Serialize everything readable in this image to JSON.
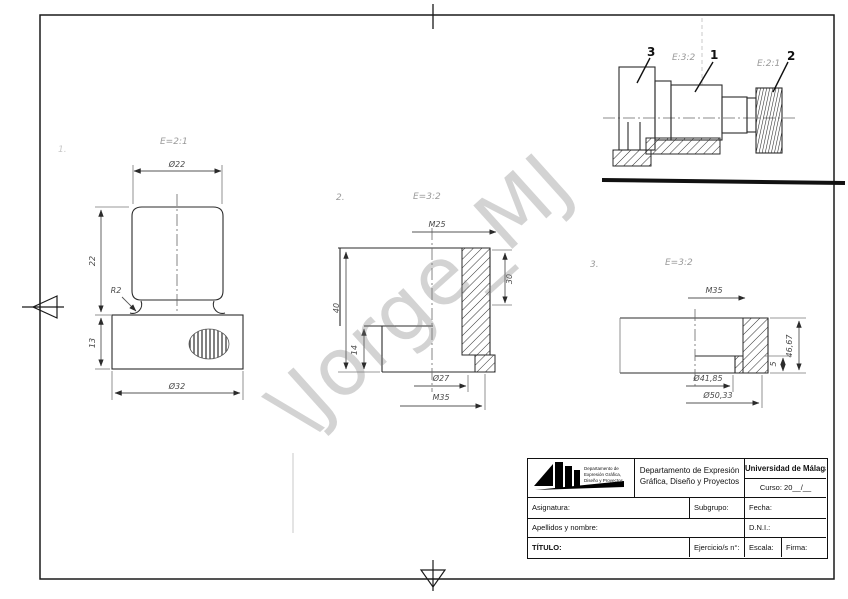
{
  "watermark": {
    "text": "\\Jorge_MJ"
  },
  "assembly": {
    "part_labels": {
      "p3": "3",
      "p1": "1",
      "p2": "2"
    },
    "scale_notes": {
      "note1": "E:3:2",
      "note2": "E:2:1"
    }
  },
  "view1": {
    "number": "1.",
    "scale": "E=2:1",
    "dim_top": "Ø22",
    "dim_height_upper": "22",
    "dim_height_lower": "13",
    "dim_radius": "R2",
    "dim_bottom": "Ø32"
  },
  "view2": {
    "number": "2.",
    "scale": "E=3:2",
    "dim_top": "M25",
    "dim_left": "40",
    "dim_inner": "14",
    "dim_right": "30",
    "dim_bottom_1": "Ø27",
    "dim_bottom_2": "M35"
  },
  "view3": {
    "number": "3.",
    "scale": "E=3:2",
    "dim_top": "M35",
    "dim_right": "46,67",
    "dim_step": "5",
    "dim_bottom_1": "Ø41,85",
    "dim_bottom_2": "Ø50,33"
  },
  "titleblock": {
    "logo_lines": {
      "l1": "Departamento de",
      "l2": "Expresión Gráfica,",
      "l3": "Diseño y Proyectos"
    },
    "department_line1": "Departamento de Expresión",
    "department_line2": "Gráfica, Diseño y Proyectos",
    "university": "Universidad de Málaga",
    "course": "Curso: 20__/__",
    "subject_label": "Asignatura:",
    "subgroup_label": "Subgrupo:",
    "date_label": "Fecha:",
    "name_label": "Apellidos y nombre:",
    "id_label": "D.N.I.:",
    "title_label": "TÍTULO:",
    "exercise_label": "Ejercicio/s n°:",
    "scale_label": "Escala:",
    "signature_label": "Firma:"
  }
}
